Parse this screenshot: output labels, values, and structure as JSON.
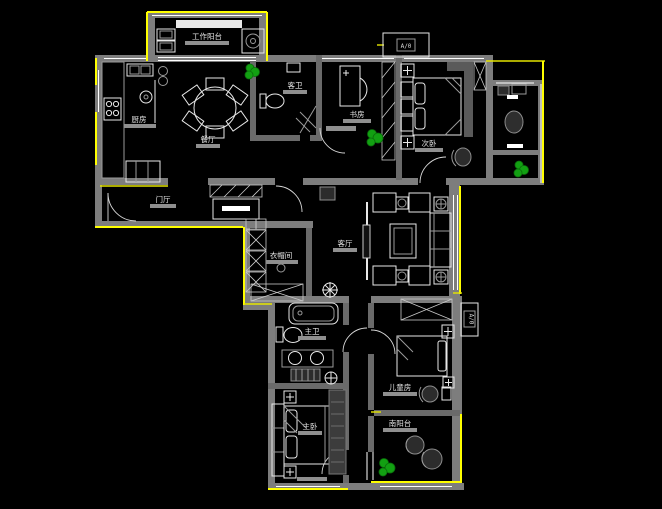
{
  "floorplan": {
    "rooms": {
      "work_balcony": "工作阳台",
      "kitchen": "厨房",
      "dining": "餐厅",
      "guest_bath": "客卫",
      "study": "书房",
      "bedroom2": "次卧",
      "foyer": "门厅",
      "closet": "衣帽间",
      "living": "客厅",
      "master_bath": "主卫",
      "master_bedroom": "主卧",
      "kids_room": "儿童房",
      "balcony": "南阳台"
    },
    "markers": {
      "section_top": "A/0",
      "section_right": "A/0"
    },
    "colors": {
      "background": "#000000",
      "wall": "#7d7d7d",
      "exterior_accent": "#ffff00",
      "line": "#ffffff",
      "plant": "#12a012",
      "label": "#e3e3e3",
      "label_bar": "#8f8f8f"
    }
  }
}
